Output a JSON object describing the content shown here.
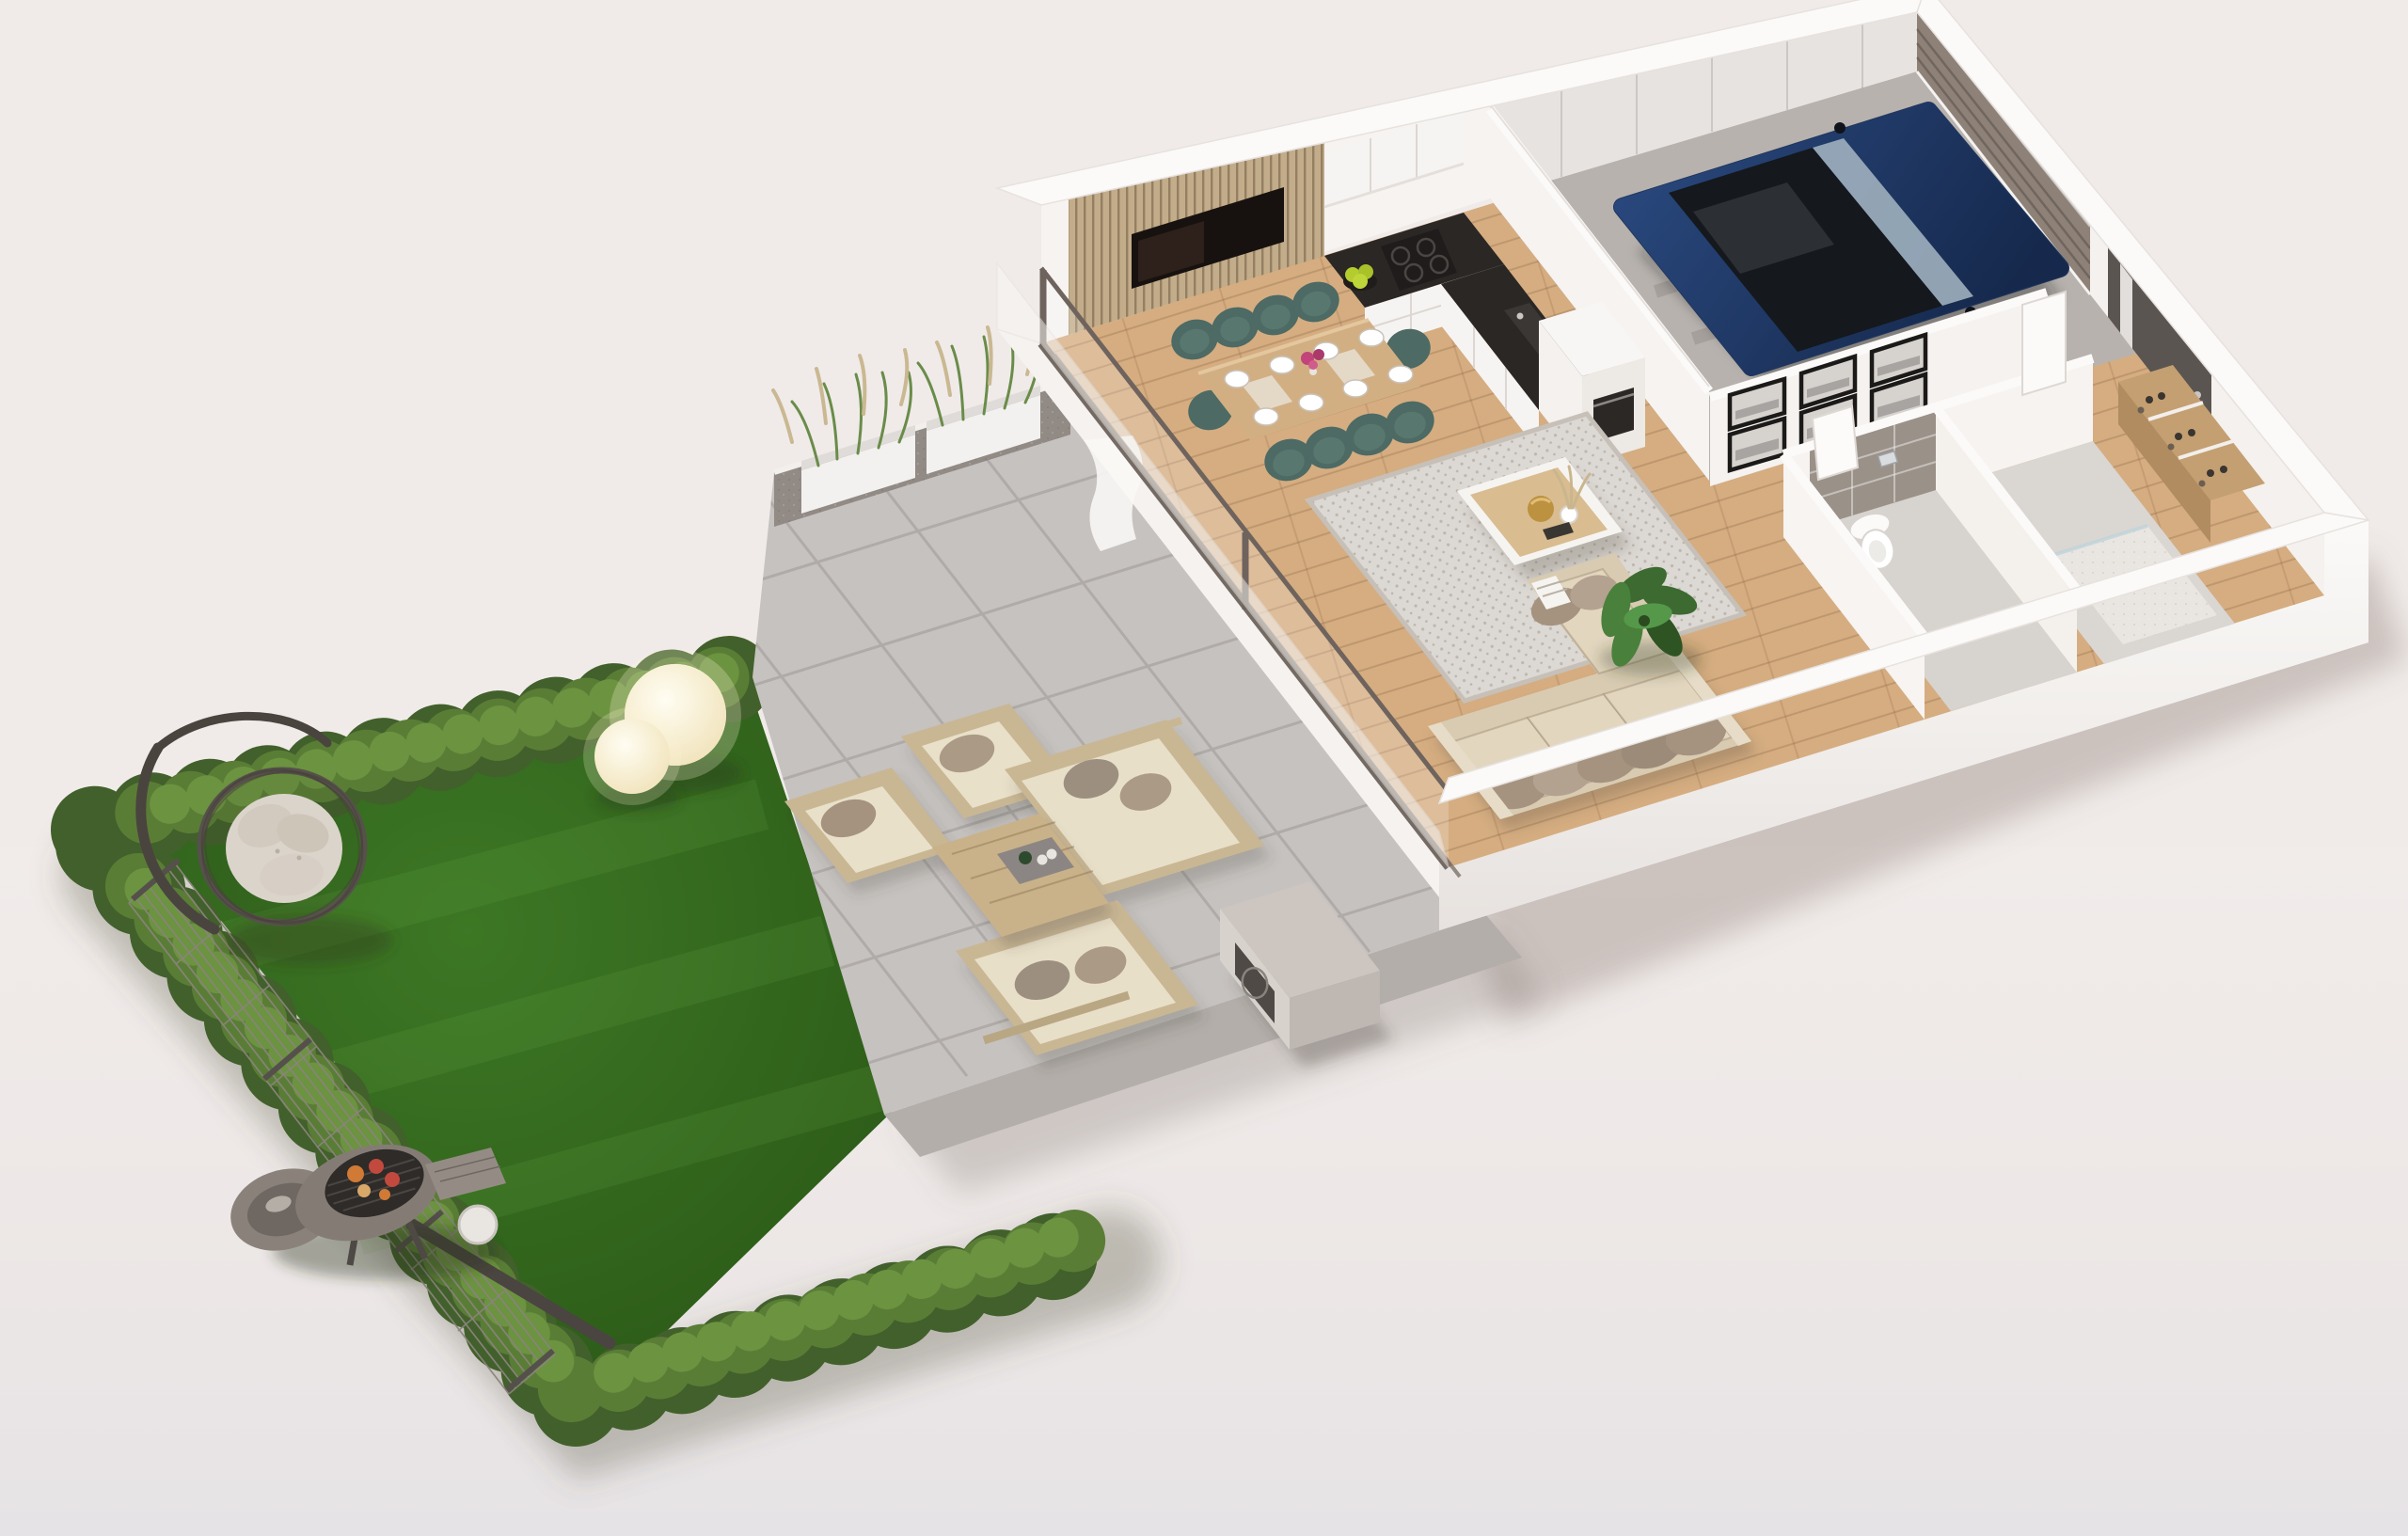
{
  "scene": {
    "kind": "3d-floor-plan-render",
    "view": "axonometric top-down cutaway",
    "description": "Single-storey home with open living/dining/kitchen, garage with car, hallway with gallery wall, WC and shower room, entry with shoe cabinet, concrete patio with lounge set and planters, hedge-enclosed lawn with hanging egg chair, sphere lamps and charcoal grill"
  },
  "palette": {
    "bg": "#F0EBE9",
    "bgBottom": "#E6E3E6",
    "wallWhite": "#F8F6F4",
    "wallShade": "#ECE7E3",
    "wallInner": "#F6F3F0",
    "garageWall": "#E7E3E0",
    "woodFloor": "#D5AD81",
    "patio": "#C6C2C0",
    "patioLine": "#ACA7A4",
    "curb": "#B3AEAA",
    "grass": "#336A1E",
    "grassLight": "#468529",
    "hedge": "#42602B",
    "hedgeMid": "#5A7D36",
    "hedgeLight": "#6C9340",
    "fence": "#8A847D",
    "fencePost": "#55504B",
    "counter": "#2A2725",
    "cabinet": "#F6F4F2",
    "slatWood": "#C2AC8A",
    "tvBlack": "#17120F",
    "tableWood": "#D2AF83",
    "chairTeal": "#4D6A64",
    "rug": "#DCD8D3",
    "sofaBeige": "#D8CBB2",
    "cushionLight": "#E2D6BF",
    "pillowTaupe": "#A5937F",
    "carNavy": "#20365C",
    "carCabin": "#15181C",
    "garageFloor": "#B7B2AE",
    "garageDoor": "#8D8178",
    "pine": "#D9B87F",
    "tileGray": "#9A9189",
    "bathFloor": "#D7D3CF",
    "showerTile": "#E9E6E2",
    "doorDark": "#5B5551",
    "frameBlack": "#1B1A19",
    "shoeWood": "#C49F72",
    "lampGlow": "#FBF3D8",
    "bbqBody": "#847C74",
    "heatPump": "#CCC5C0",
    "glassTrack": "#6E635D",
    "planterWall": "#918A85",
    "planterBox": "#F3F1EF",
    "plantGreen": "#3C6A31",
    "apples": "#B5CC2E",
    "flowers": "#C2447A"
  },
  "garden": {
    "lawn": "natural grass",
    "border": "trimmed boxwood hedge on three sides",
    "fence": "wire mesh fence with metal posts along the left side",
    "objects": [
      "hanging-egg-chair",
      "sphere-lamp-large",
      "sphere-lamp-small",
      "charcoal-grill-with-food",
      "gas-bottle"
    ]
  },
  "patio": {
    "surface": "large concrete pavers",
    "objects": [
      "planter-box-1",
      "planter-box-2",
      "ornamental-grasses",
      "outdoor-armchair-1",
      "outdoor-armchair-2",
      "outdoor-sofa-1",
      "outdoor-sofa-2",
      "outdoor-coffee-table",
      "serving-tray",
      "heat-pump-unit",
      "white-pillar"
    ]
  },
  "house": {
    "living_room": [
      "tv-slat-wall",
      "tv-screen",
      "area-rug",
      "coffee-table",
      "pampas-vase",
      "gold-tray",
      "sectional-sofa",
      "throw-pillows",
      "monstera-plant",
      "sliding-glass-door",
      "curtain"
    ],
    "dining": [
      "wood-dining-table",
      "teal-chairs",
      "place-settings",
      "flower-vase"
    ],
    "kitchen": [
      "white-cabinets",
      "black-countertop",
      "induction-hob",
      "apple-bowl",
      "sink",
      "tall-unit-with-oven",
      "upper-cabinets"
    ],
    "garage": [
      "dark-blue-car",
      "pine-shelving-with-bins",
      "sectional-garage-door",
      "door-rail"
    ],
    "hallway": [
      "gallery-wall-six-frames"
    ],
    "bathroom": [
      "gray-tiled-wall",
      "flush-plate",
      "toilet",
      "washbasin"
    ],
    "shower_room": [
      "shower-tray"
    ],
    "entry": [
      "front-door-with-glass-stripe",
      "interior-door",
      "shoe-cabinet-with-shoes"
    ]
  }
}
